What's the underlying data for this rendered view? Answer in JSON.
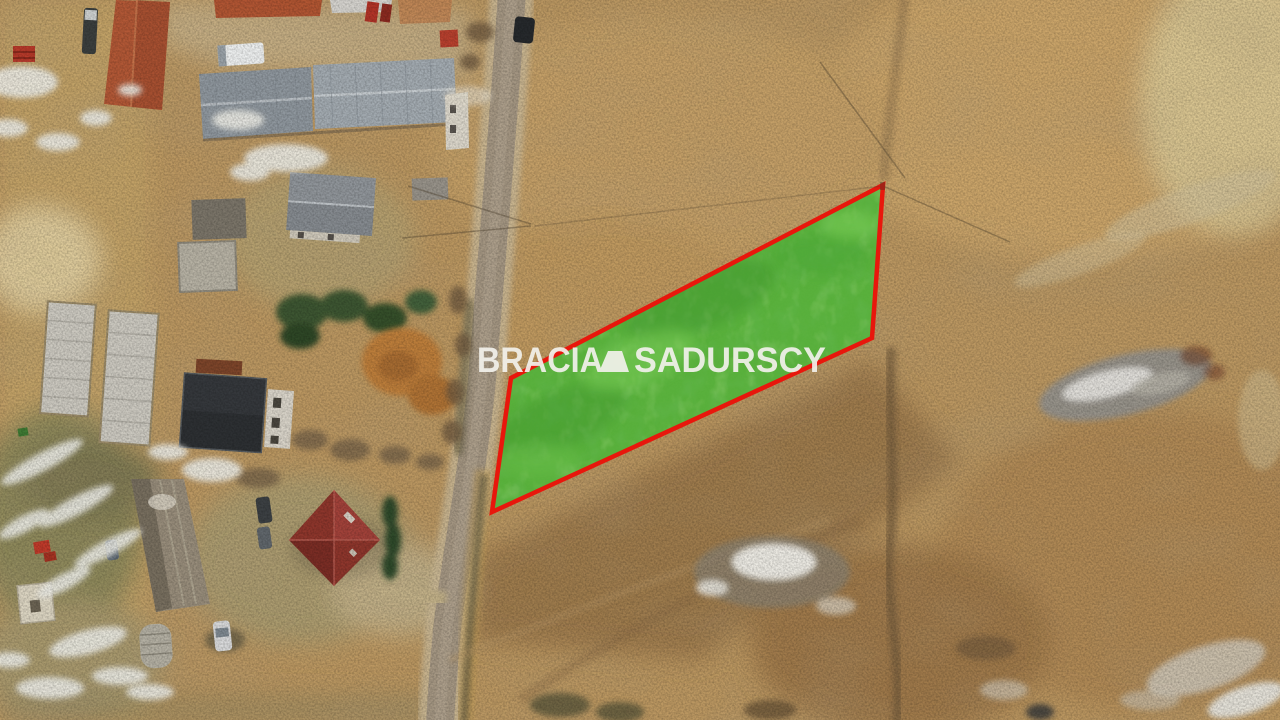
{
  "watermark": {
    "brand_word_1": "BRACIA",
    "brand_word_2": "SADURSCY",
    "logo": "bracia-sadurscy-logo-mark",
    "color": "#F2F1EC"
  },
  "parcel": {
    "fill_color": "#53B13A",
    "outline_color": "#E8170C"
  },
  "palette": {
    "field_tan": "#BC9862",
    "field_gold": "#CBA56A",
    "field_dark_brown": "#9A774B",
    "road_gray": "#A59783",
    "snow_white": "#EDECE6",
    "red_roof_house": "#8E362C",
    "red_roof_barn": "#B25836",
    "dark_roof_house": "#2D3033",
    "warehouse_gray": "#98A0A6",
    "larch_orange": "#BD7E3A",
    "tree_green": "#3D5632"
  }
}
